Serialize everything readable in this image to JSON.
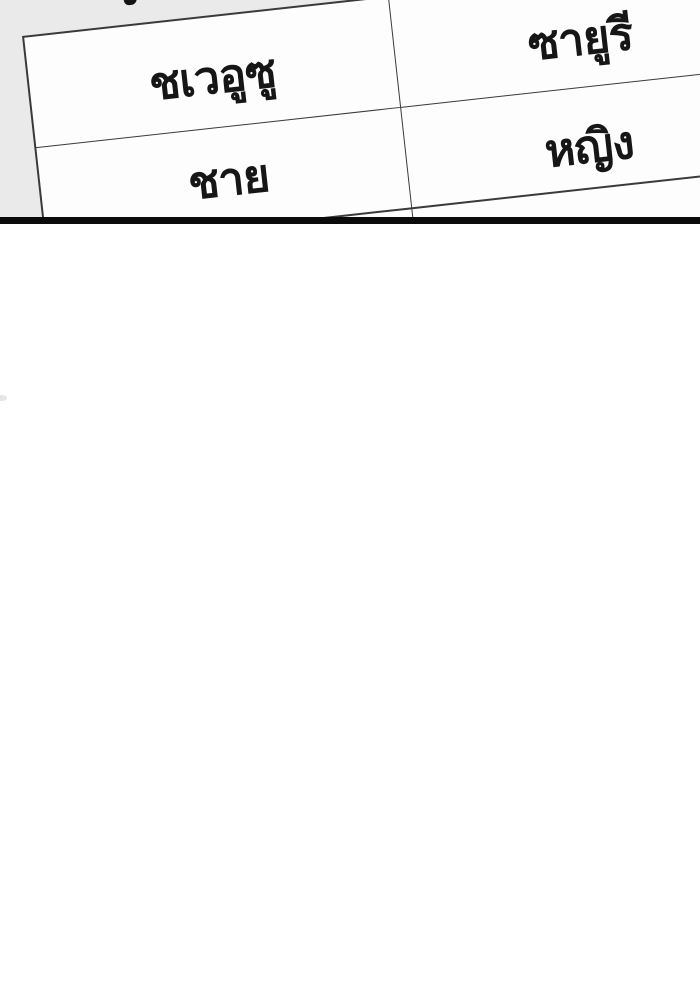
{
  "colors": {
    "panel_bg": "#eaeaea",
    "table_border": "#3a3a3a",
    "cell_bg": "#fdfdfd",
    "divider": "#0b0b0b",
    "text": "#161616"
  },
  "panel": {
    "table": {
      "rows": [
        {
          "cells": [
            "ชเวอูซู",
            "ซายูรี"
          ]
        },
        {
          "cells": [
            "ชาย",
            "หญิง"
          ]
        },
        {
          "cells": [
            "",
            ""
          ]
        }
      ]
    }
  }
}
